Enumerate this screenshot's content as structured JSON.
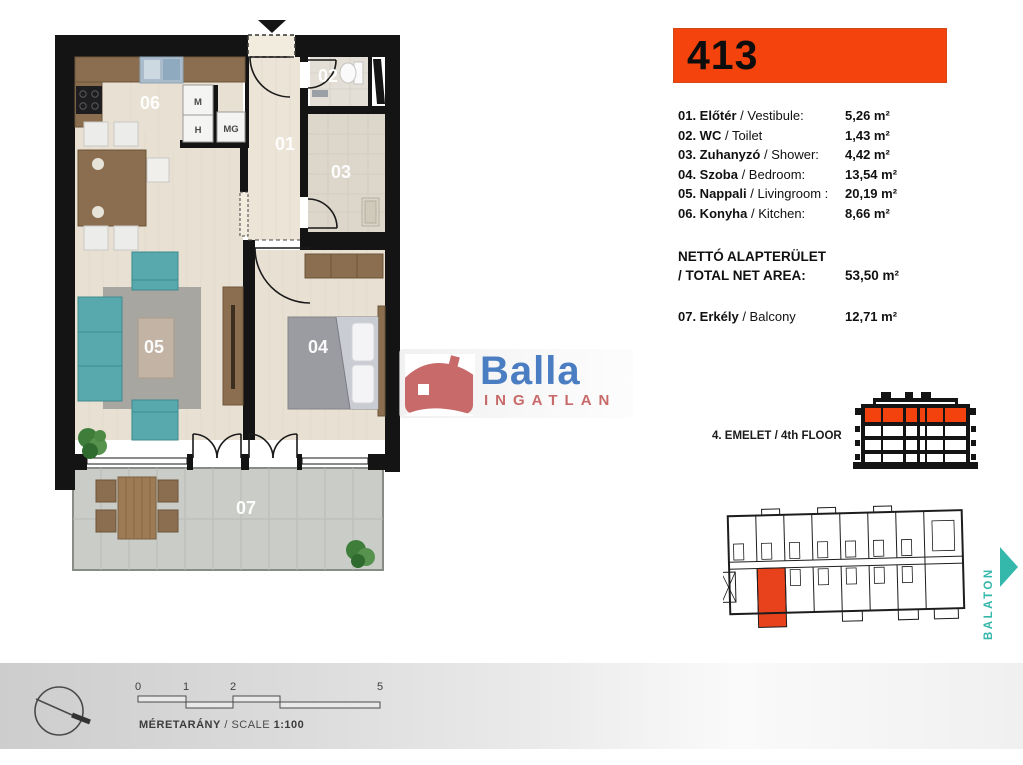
{
  "unit_number": "413",
  "room_list": [
    {
      "bold": "01. Előtér",
      "rest": " / Vestibule:",
      "area": "5,26 m²"
    },
    {
      "bold": "02. WC",
      "rest": " / Toilet",
      "area": "1,43 m²"
    },
    {
      "bold": "03. Zuhanyzó",
      "rest": " / Shower:",
      "area": "4,42 m²"
    },
    {
      "bold": "04. Szoba",
      "rest": " / Bedroom:",
      "area": "13,54 m²"
    },
    {
      "bold": "05. Nappali",
      "rest": " / Livingroom :",
      "area": "20,19 m²"
    },
    {
      "bold": "06. Konyha",
      "rest": " / Kitchen:",
      "area": "8,66 m²"
    }
  ],
  "total": {
    "line1": "NETTÓ ALAPTERÜLET",
    "line2": "/ TOTAL NET AREA:",
    "area": "53,50 m²"
  },
  "balcony_row": {
    "bold": "07. Erkély",
    "rest": " / Balcony",
    "area": "12,71 m²"
  },
  "floor_label": {
    "bold": "4. EMELET",
    "rest": " / 4th FLOOR"
  },
  "logo": {
    "name": "Balla",
    "subtitle": "INGATLAN"
  },
  "plan_labels": {
    "r01": "01",
    "r02": "02",
    "r03": "03",
    "r04": "04",
    "r05": "05",
    "r06": "06",
    "r07": "07"
  },
  "appliances": {
    "m": "M",
    "h": "H",
    "mg": "MG"
  },
  "site": {
    "direction_label": "BALATON"
  },
  "scale_bar": {
    "ticks": [
      "0",
      "1",
      "2",
      "5"
    ],
    "label_bold": "MÉRETARÁNY",
    "label_rest": "/ SCALE",
    "ratio": "1:100"
  },
  "colors": {
    "accent_orange": "#f5430d",
    "logo_blue": "#4a7dc2",
    "logo_red": "#c96a6a",
    "teal": "#35b8ac"
  }
}
